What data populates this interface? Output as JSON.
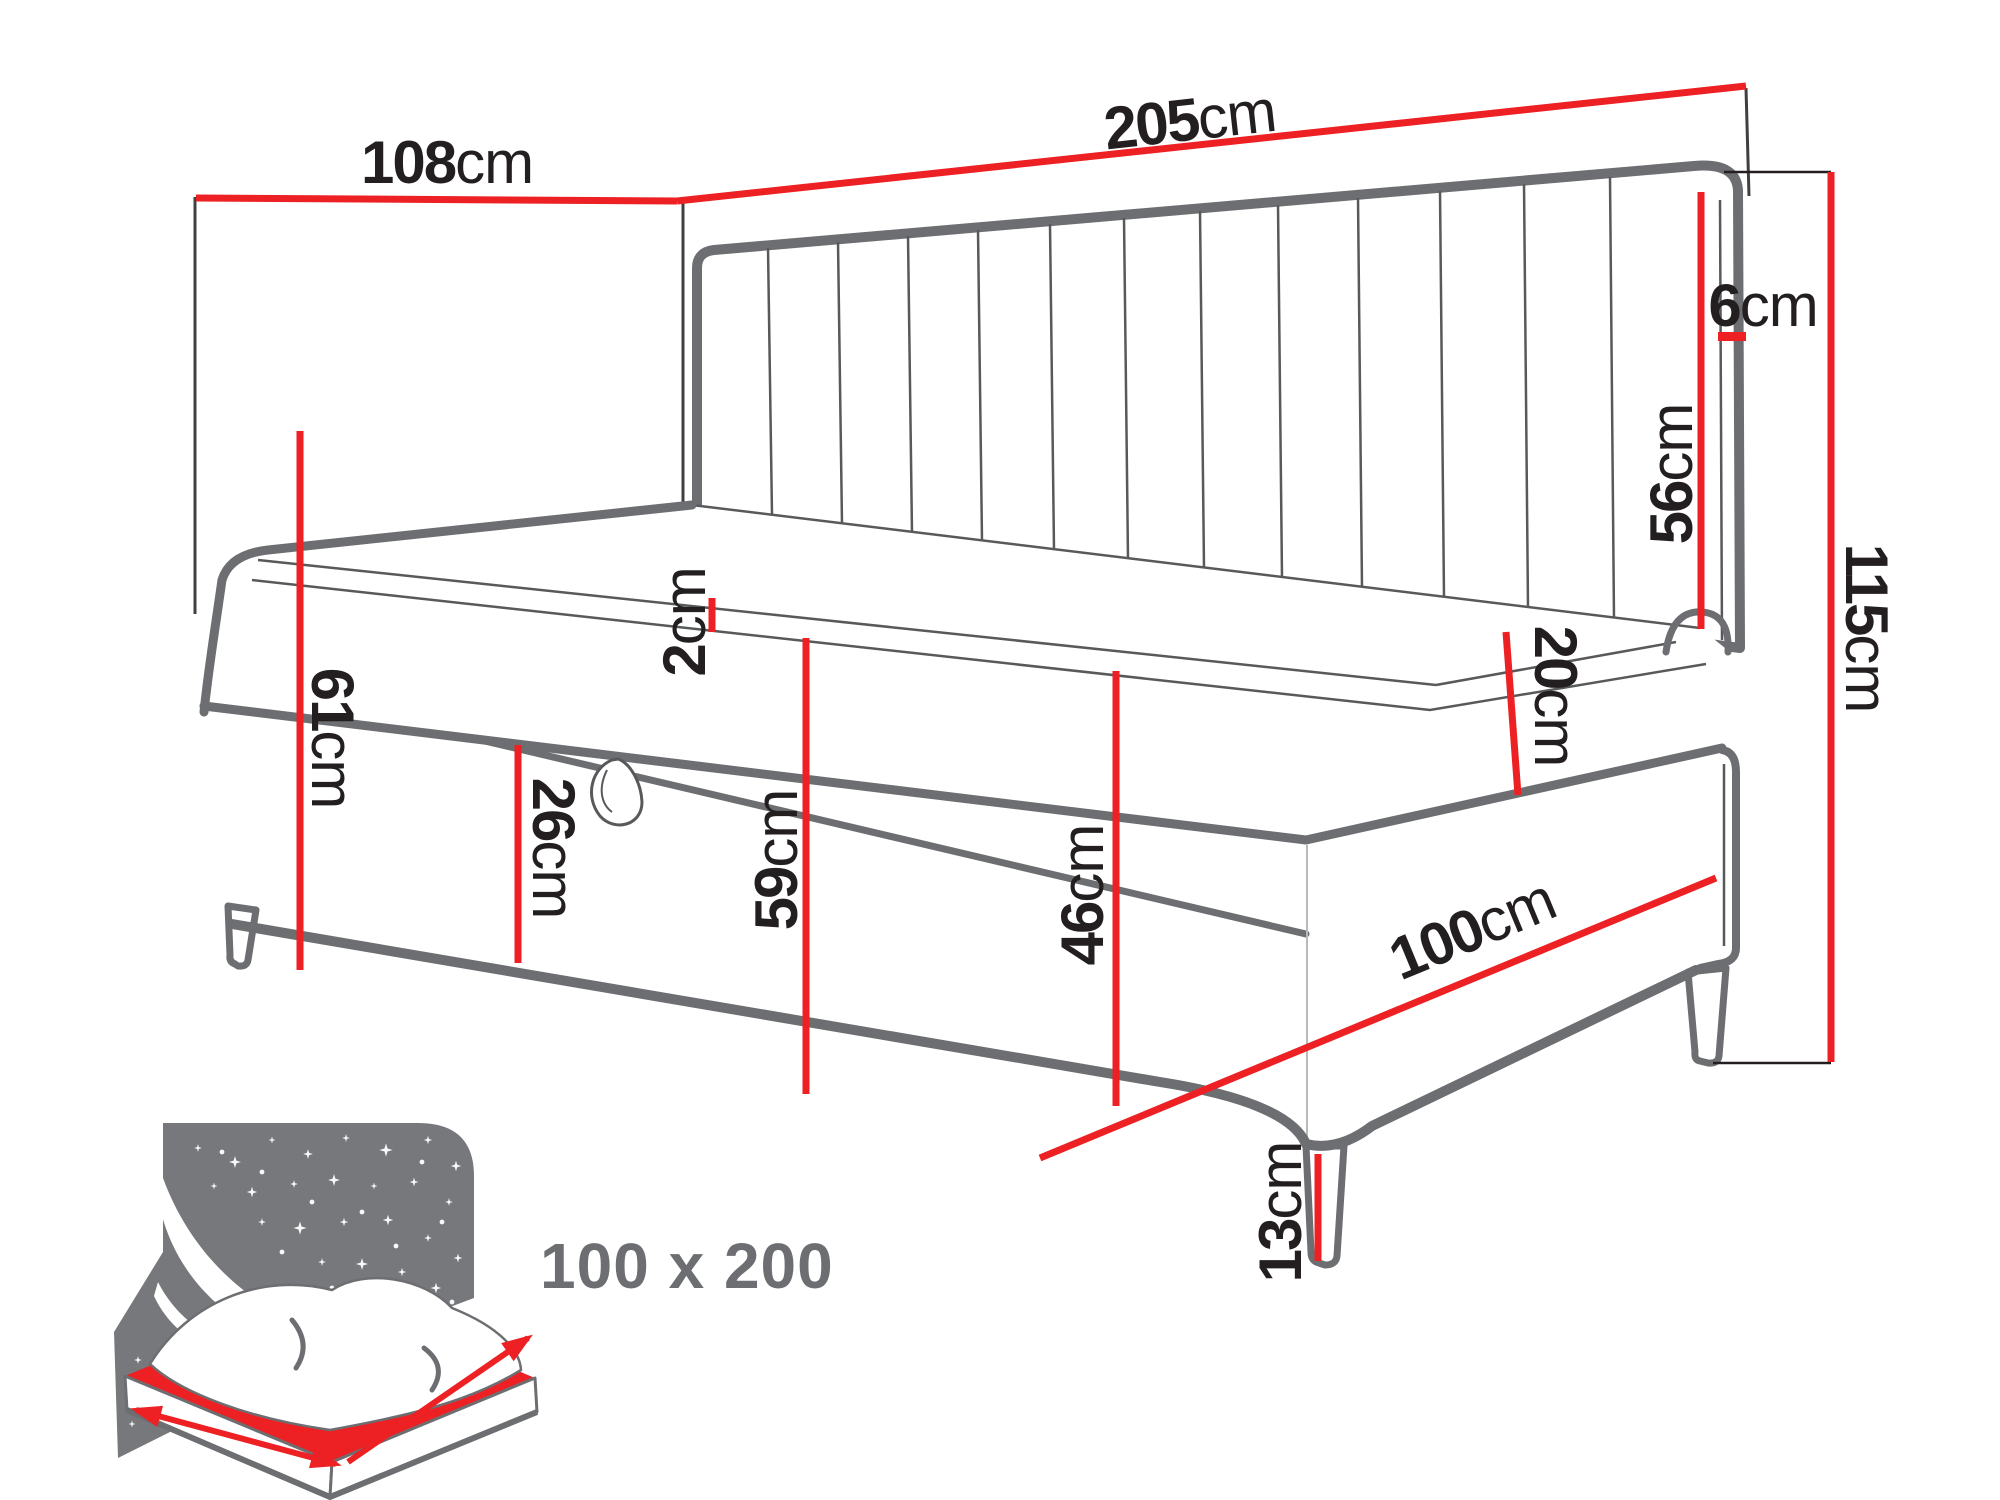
{
  "dimensions": {
    "d108": {
      "num": "108",
      "unit": "cm"
    },
    "d205": {
      "num": "205",
      "unit": "cm"
    },
    "d6": {
      "num": "6",
      "unit": "cm"
    },
    "d56": {
      "num": "56",
      "unit": "cm"
    },
    "d115": {
      "num": "115",
      "unit": "cm"
    },
    "d2": {
      "num": "2",
      "unit": "cm"
    },
    "d61": {
      "num": "61",
      "unit": "cm"
    },
    "d26": {
      "num": "26",
      "unit": "cm"
    },
    "d59": {
      "num": "59",
      "unit": "cm"
    },
    "d46": {
      "num": "46",
      "unit": "cm"
    },
    "d20": {
      "num": "20",
      "unit": "cm"
    },
    "d100": {
      "num": "100",
      "unit": "cm"
    },
    "d13": {
      "num": "13",
      "unit": "cm"
    }
  },
  "badge": {
    "size": "100 x 200"
  },
  "colors": {
    "dimension_red": "#ed2024",
    "upholstery_gray": "#6d6e71",
    "outline_dark": "#58595b",
    "label_black": "#231f20",
    "badge_gray": "#6d6e71",
    "night_sky_gray": "#77787b"
  }
}
